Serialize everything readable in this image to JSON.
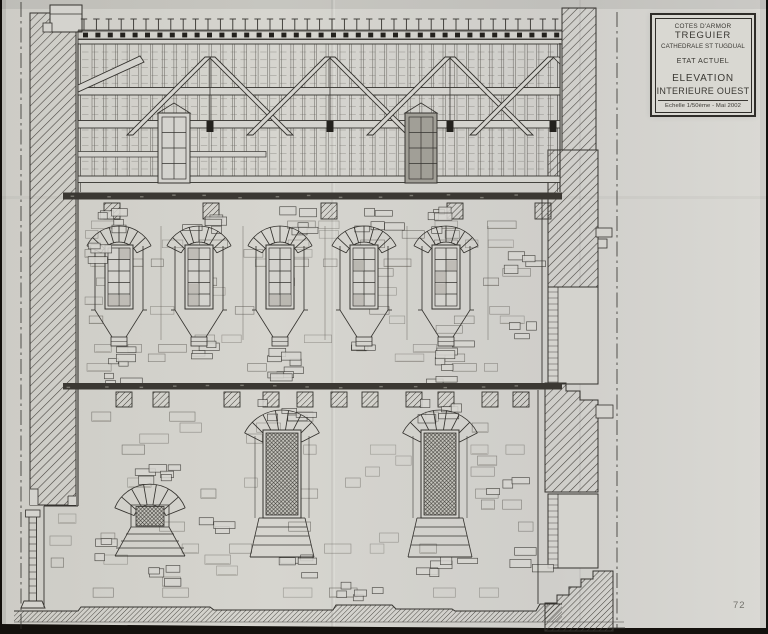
{
  "colors": {
    "paper": "#d4d3ce",
    "ink": "#35332f",
    "photo_background": "#14110d"
  },
  "title_block": {
    "region": "COTES D'ARMOR",
    "city": "TREGUIER",
    "building": "CATHEDRALE ST TUGDUAL",
    "state": "ETAT ACTUEL",
    "drawing_title_line1": "ELEVATION",
    "drawing_title_line2": "INTERIEURE OUEST",
    "scale_and_date": "Echelle 1/50ème - Mai 2002"
  },
  "page_number": "72"
}
